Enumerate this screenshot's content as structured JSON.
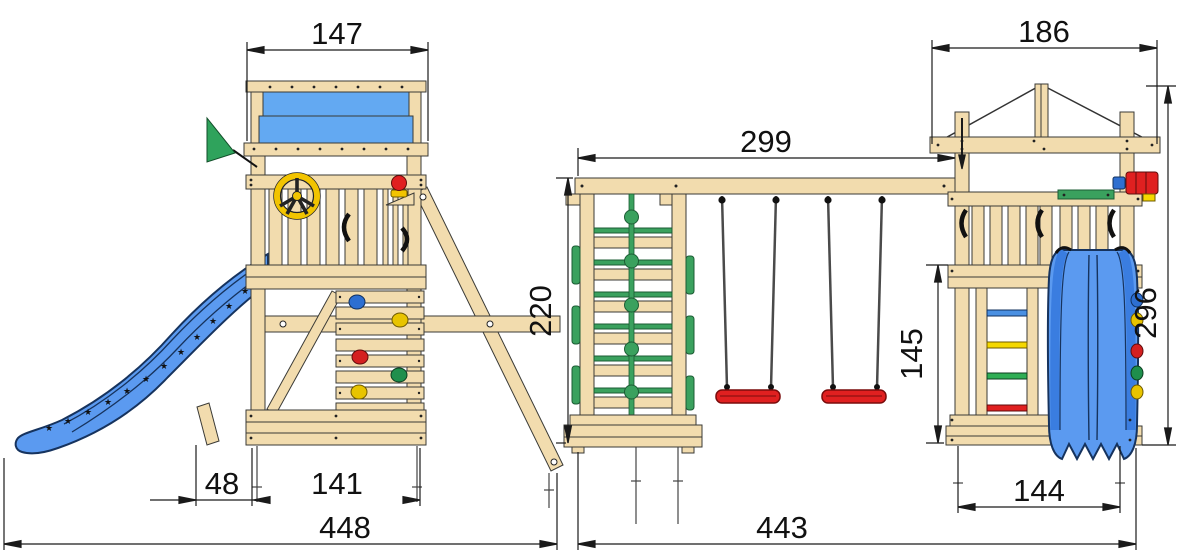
{
  "title": "playground-set-dimension-drawing",
  "dimensions": {
    "left_roof_width": "147",
    "left_offset": "48",
    "left_base_width": "141",
    "left_total_width": "448",
    "beam_length": "299",
    "climb_frame_height": "220",
    "right_deck_height": "145",
    "right_roof_width": "186",
    "right_tower_height": "296",
    "right_base_width": "144",
    "right_total_width": "443"
  },
  "colors": {
    "wood": "#f2dcae",
    "wood_shade": "#dfc18a",
    "outline": "#3a3a36",
    "tarp_blue": "#63a9f2",
    "slide_blue": "#5b9af0",
    "slide_dark": "#16335e",
    "green": "#3aa15e",
    "green_dark": "#1c5c34",
    "red": "#e02020",
    "yellow": "#f2c400",
    "dim_line": "#1a1a1a"
  }
}
